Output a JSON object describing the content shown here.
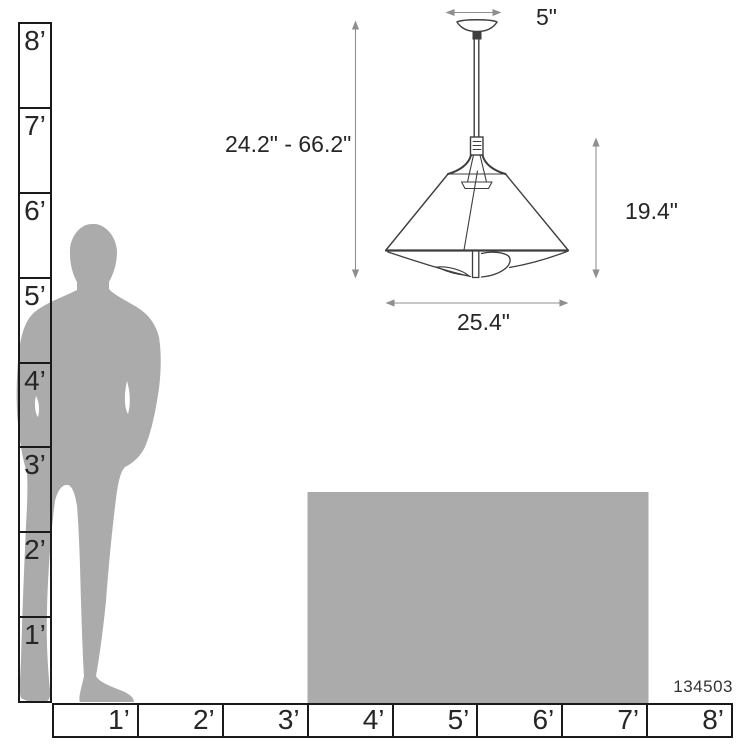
{
  "diagram": {
    "product_code": "134503",
    "dimension_labels": {
      "canopy_width": "5\"",
      "hanging_height": "24.2\" - 66.2\"",
      "fixture_height": "19.4\"",
      "fixture_width": "25.4\""
    },
    "rulers": {
      "vertical_labels": [
        "8’",
        "7’",
        "6’",
        "5’",
        "4’",
        "3’",
        "2’",
        "1’"
      ],
      "horizontal_labels": [
        "1’",
        "2’",
        "3’",
        "4’",
        "5’",
        "6’",
        "7’",
        "8’"
      ]
    },
    "colors": {
      "figure_gray": "#ababab",
      "ruler_line": "#1a1a1a",
      "lamp_line": "#3e3e3e",
      "dimension_line": "#8f8f8f",
      "text": "#262626"
    }
  }
}
